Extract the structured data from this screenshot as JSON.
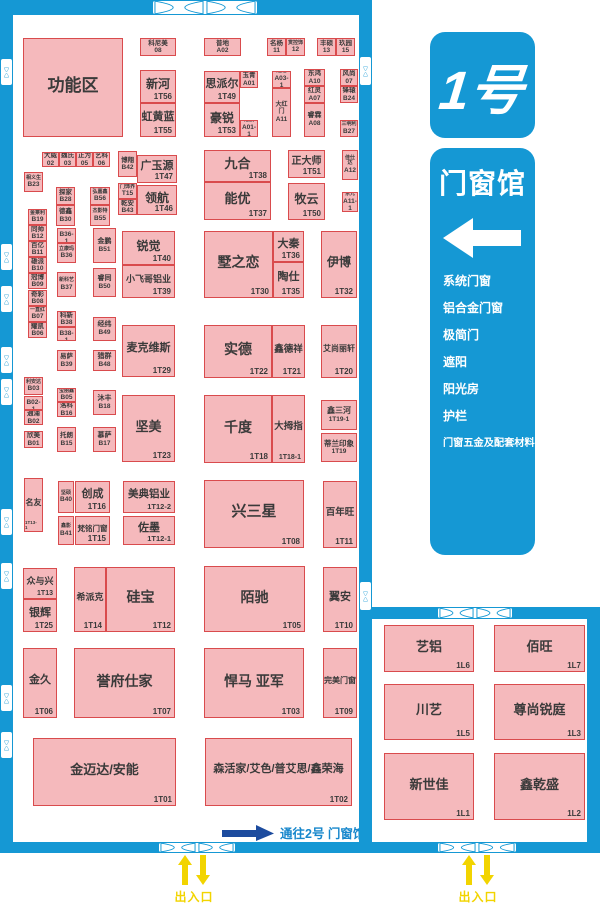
{
  "legend": {
    "hall_number": "1号",
    "hall_name": "门窗馆",
    "categories": [
      "系统门窗",
      "铝合金门窗",
      "极简门",
      "遮阳",
      "阳光房",
      "护栏",
      "门窗五金及配套材料"
    ]
  },
  "annotations": {
    "to_hall2": "通往2号 门窗馆",
    "entrance_exit": "出入口"
  },
  "colors": {
    "wall_blue": "#1598D4",
    "booth_fill": "#F5B9BC",
    "booth_border": "#D94B4D",
    "booth_text": "#3A3A3A",
    "navy_arrow": "#1C4B9E",
    "yellow": "#F2D400",
    "to_hall2_text": "#1787CC"
  },
  "booths": [
    {
      "n": "功能区",
      "c": "",
      "x": 23,
      "y": 38,
      "w": 100,
      "h": 99,
      "nf": 17
    },
    {
      "n": "科尼美",
      "c": "08",
      "x": 140,
      "y": 38,
      "w": 36,
      "h": 18,
      "t": "sm"
    },
    {
      "n": "新河",
      "c": "1T56",
      "x": 140,
      "y": 70,
      "w": 36,
      "h": 33,
      "nf": 12
    },
    {
      "n": "虹黄蓝",
      "c": "1T55",
      "x": 140,
      "y": 103,
      "w": 36,
      "h": 34,
      "nf": 11
    },
    {
      "n": "普地",
      "c": "A02",
      "x": 204,
      "y": 38,
      "w": 37,
      "h": 18,
      "t": "sm"
    },
    {
      "n": "名杨",
      "c": "11",
      "x": 267,
      "y": 38,
      "w": 19,
      "h": 18,
      "t": "sm"
    },
    {
      "n": "赏控饰",
      "c": "12",
      "x": 286,
      "y": 38,
      "w": 19,
      "h": 18,
      "t": "sm",
      "nf": 5
    },
    {
      "n": "丰硕",
      "c": "13",
      "x": 317,
      "y": 38,
      "w": 19,
      "h": 18,
      "t": "sm"
    },
    {
      "n": "玖园",
      "c": "15",
      "x": 336,
      "y": 38,
      "w": 19,
      "h": 18,
      "t": "sm"
    },
    {
      "n": "思派尔",
      "c": "1T49",
      "x": 204,
      "y": 71,
      "w": 36,
      "h": 32,
      "nf": 11
    },
    {
      "n": "玉青",
      "c": "A01",
      "x": 240,
      "y": 71,
      "w": 18,
      "h": 17,
      "t": "sm"
    },
    {
      "n": "豪锐",
      "c": "1T53",
      "x": 204,
      "y": 103,
      "w": 36,
      "h": 34,
      "nf": 12
    },
    {
      "n": "冠航",
      "c": "A01-1",
      "x": 240,
      "y": 120,
      "w": 18,
      "h": 17,
      "t": "sm",
      "nf": 5
    },
    {
      "n": "赵越",
      "c": "A03-1",
      "x": 272,
      "y": 71,
      "w": 19,
      "h": 17,
      "t": "sm",
      "nf": 5
    },
    {
      "n": "大红门",
      "c": "A11",
      "x": 272,
      "y": 88,
      "w": 19,
      "h": 49,
      "t": "sm",
      "nf": 6
    },
    {
      "n": "东鸿",
      "c": "A10",
      "x": 304,
      "y": 69,
      "w": 21,
      "h": 17,
      "t": "sm"
    },
    {
      "n": "红灵",
      "c": "A07",
      "x": 304,
      "y": 86,
      "w": 21,
      "h": 17,
      "t": "sm"
    },
    {
      "n": "睿霖",
      "c": "A08",
      "x": 304,
      "y": 103,
      "w": 21,
      "h": 34,
      "t": "sm",
      "nf": 7
    },
    {
      "n": "风尚",
      "c": "07",
      "x": 340,
      "y": 69,
      "w": 18,
      "h": 17,
      "t": "sm"
    },
    {
      "n": "锋辕",
      "c": "B24",
      "x": 340,
      "y": 86,
      "w": 18,
      "h": 17,
      "t": "sm"
    },
    {
      "n": "三明利",
      "c": "B27",
      "x": 340,
      "y": 120,
      "w": 18,
      "h": 17,
      "t": "sm",
      "nf": 5
    },
    {
      "n": "大威",
      "c": "02",
      "x": 42,
      "y": 152,
      "w": 17,
      "h": 15,
      "t": "sm"
    },
    {
      "n": "魏氏",
      "c": "03",
      "x": 59,
      "y": 152,
      "w": 17,
      "h": 15,
      "t": "sm"
    },
    {
      "n": "正为",
      "c": "05",
      "x": 76,
      "y": 152,
      "w": 17,
      "h": 15,
      "t": "sm"
    },
    {
      "n": "艺科",
      "c": "06",
      "x": 93,
      "y": 152,
      "w": 17,
      "h": 15,
      "t": "sm"
    },
    {
      "n": "博翔",
      "c": "B42",
      "x": 118,
      "y": 151,
      "w": 19,
      "h": 26,
      "t": "sm"
    },
    {
      "n": "广玉源",
      "c": "1T47",
      "x": 137,
      "y": 155,
      "w": 40,
      "h": 28,
      "nf": 11
    },
    {
      "n": "门饰界",
      "c": "T15",
      "x": 118,
      "y": 183,
      "w": 19,
      "h": 16,
      "t": "sm",
      "nf": 5
    },
    {
      "n": "乾安",
      "c": "B43",
      "x": 118,
      "y": 199,
      "w": 19,
      "h": 16,
      "t": "sm"
    },
    {
      "n": "领航",
      "c": "1T46",
      "x": 137,
      "y": 185,
      "w": 40,
      "h": 30,
      "nf": 12
    },
    {
      "n": "九合",
      "c": "1T38",
      "x": 204,
      "y": 150,
      "w": 67,
      "h": 32,
      "nf": 13
    },
    {
      "n": "能优",
      "c": "1T37",
      "x": 204,
      "y": 182,
      "w": 67,
      "h": 38,
      "nf": 13
    },
    {
      "n": "正大师",
      "c": "1T51",
      "x": 288,
      "y": 150,
      "w": 37,
      "h": 28,
      "nf": 10
    },
    {
      "n": "牧云",
      "c": "1T50",
      "x": 288,
      "y": 183,
      "w": 37,
      "h": 37,
      "nf": 12
    },
    {
      "n": "佳仕达",
      "c": "A12",
      "x": 342,
      "y": 150,
      "w": 16,
      "h": 30,
      "t": "sm",
      "nf": 5
    },
    {
      "n": "东元",
      "c": "A11-1",
      "x": 342,
      "y": 192,
      "w": 16,
      "h": 20,
      "t": "sm",
      "nf": 5
    },
    {
      "n": "相义生",
      "c": "B23",
      "x": 24,
      "y": 172,
      "w": 19,
      "h": 20,
      "t": "sm",
      "nf": 5
    },
    {
      "n": "金莱利",
      "c": "B19",
      "x": 28,
      "y": 209,
      "w": 19,
      "h": 16,
      "t": "sm",
      "nf": 5
    },
    {
      "n": "同帅",
      "c": "B12",
      "x": 28,
      "y": 225,
      "w": 19,
      "h": 16,
      "t": "sm"
    },
    {
      "n": "百亿",
      "c": "B11",
      "x": 28,
      "y": 241,
      "w": 19,
      "h": 16,
      "t": "sm"
    },
    {
      "n": "雄派",
      "c": "B10",
      "x": 28,
      "y": 257,
      "w": 19,
      "h": 16,
      "t": "sm"
    },
    {
      "n": "冠博",
      "c": "B09",
      "x": 28,
      "y": 273,
      "w": 19,
      "h": 16,
      "t": "sm"
    },
    {
      "n": "奇彩",
      "c": "B08",
      "x": 28,
      "y": 290,
      "w": 19,
      "h": 16,
      "t": "sm"
    },
    {
      "n": "一直红",
      "c": "B07",
      "x": 28,
      "y": 306,
      "w": 19,
      "h": 16,
      "t": "sm",
      "nf": 5
    },
    {
      "n": "耀凯",
      "c": "B06",
      "x": 28,
      "y": 322,
      "w": 19,
      "h": 16,
      "t": "sm"
    },
    {
      "n": "探家",
      "c": "B28",
      "x": 56,
      "y": 187,
      "w": 19,
      "h": 18,
      "t": "sm"
    },
    {
      "n": "德鑫",
      "c": "B30",
      "x": 56,
      "y": 205,
      "w": 19,
      "h": 21,
      "t": "sm"
    },
    {
      "n": "弘嘉鑫",
      "c": "B56",
      "x": 90,
      "y": 187,
      "w": 20,
      "h": 18,
      "t": "sm",
      "nf": 5
    },
    {
      "n": "杰影特",
      "c": "B55",
      "x": 90,
      "y": 205,
      "w": 20,
      "h": 21,
      "t": "sm",
      "nf": 5
    },
    {
      "n": "利安达",
      "c": "B03",
      "x": 24,
      "y": 377,
      "w": 19,
      "h": 18,
      "t": "sm",
      "nf": 5
    },
    {
      "n": "角园",
      "c": "B02-1",
      "x": 24,
      "y": 396,
      "w": 19,
      "h": 14,
      "t": "sm",
      "nf": 5
    },
    {
      "n": "通浦",
      "c": "B02",
      "x": 24,
      "y": 410,
      "w": 19,
      "h": 15,
      "t": "sm"
    },
    {
      "n": "欣美",
      "c": "B01",
      "x": 24,
      "y": 431,
      "w": 19,
      "h": 17,
      "t": "sm"
    },
    {
      "n": "名友",
      "c": "1T13-1",
      "x": 24,
      "y": 478,
      "w": 19,
      "h": 54,
      "nf": 8,
      "cf": 4.5
    },
    {
      "n": "彬利",
      "c": "B36-1",
      "x": 57,
      "y": 228,
      "w": 19,
      "h": 15,
      "t": "sm",
      "nf": 5
    },
    {
      "n": "立康玛",
      "c": "B36",
      "x": 57,
      "y": 243,
      "w": 19,
      "h": 20,
      "t": "sm",
      "nf": 5
    },
    {
      "n": "新科艺",
      "c": "B37",
      "x": 57,
      "y": 272,
      "w": 19,
      "h": 25,
      "t": "sm",
      "nf": 5
    },
    {
      "n": "金鹏",
      "c": "B51",
      "x": 93,
      "y": 228,
      "w": 23,
      "h": 35,
      "t": "sm",
      "nf": 7
    },
    {
      "n": "睿同",
      "c": "B50",
      "x": 93,
      "y": 268,
      "w": 23,
      "h": 29,
      "t": "sm",
      "nf": 7
    },
    {
      "n": "科新",
      "c": "B38",
      "x": 57,
      "y": 311,
      "w": 19,
      "h": 16,
      "t": "sm"
    },
    {
      "n": "宾普",
      "c": "B38-1",
      "x": 57,
      "y": 327,
      "w": 19,
      "h": 14,
      "t": "sm",
      "nf": 5
    },
    {
      "n": "易萨",
      "c": "B39",
      "x": 57,
      "y": 350,
      "w": 19,
      "h": 21,
      "t": "sm"
    },
    {
      "n": "经纬",
      "c": "B49",
      "x": 93,
      "y": 317,
      "w": 23,
      "h": 24,
      "t": "sm",
      "nf": 7
    },
    {
      "n": "猎群",
      "c": "B48",
      "x": 93,
      "y": 350,
      "w": 23,
      "h": 21,
      "t": "sm",
      "nf": 7
    },
    {
      "n": "宝丽鑫",
      "c": "B05",
      "x": 57,
      "y": 388,
      "w": 19,
      "h": 14,
      "t": "sm",
      "nf": 5
    },
    {
      "n": "洛科",
      "c": "B16",
      "x": 57,
      "y": 402,
      "w": 19,
      "h": 15,
      "t": "sm"
    },
    {
      "n": "托朗",
      "c": "B15",
      "x": 57,
      "y": 427,
      "w": 19,
      "h": 25,
      "t": "sm"
    },
    {
      "n": "沐丰",
      "c": "B18",
      "x": 93,
      "y": 390,
      "w": 23,
      "h": 25,
      "t": "sm",
      "nf": 7
    },
    {
      "n": "慕萨",
      "c": "B17",
      "x": 93,
      "y": 427,
      "w": 23,
      "h": 25,
      "t": "sm",
      "nf": 7
    },
    {
      "n": "坚硕",
      "c": "B40",
      "x": 58,
      "y": 481,
      "w": 16,
      "h": 32,
      "t": "sm",
      "nf": 5
    },
    {
      "n": "鑫影",
      "c": "B41",
      "x": 58,
      "y": 516,
      "w": 16,
      "h": 29,
      "t": "sm",
      "nf": 5
    },
    {
      "n": "锐觉",
      "c": "1T40",
      "x": 122,
      "y": 231,
      "w": 53,
      "h": 34,
      "nf": 12
    },
    {
      "n": "小飞哥铝业",
      "c": "1T39",
      "x": 122,
      "y": 265,
      "w": 53,
      "h": 33,
      "nf": 9
    },
    {
      "n": "墅之恋",
      "c": "1T30",
      "x": 204,
      "y": 231,
      "w": 69,
      "h": 67,
      "nf": 14
    },
    {
      "n": "大秦",
      "c": "1T36",
      "x": 273,
      "y": 231,
      "w": 31,
      "h": 31,
      "nf": 11
    },
    {
      "n": "陶仕",
      "c": "1T35",
      "x": 273,
      "y": 262,
      "w": 31,
      "h": 36,
      "nf": 11
    },
    {
      "n": "伊博",
      "c": "1T32",
      "x": 321,
      "y": 231,
      "w": 36,
      "h": 67,
      "nf": 12
    },
    {
      "n": "麦克维斯",
      "c": "1T29",
      "x": 122,
      "y": 325,
      "w": 53,
      "h": 52,
      "nf": 11
    },
    {
      "n": "实德",
      "c": "1T22",
      "x": 204,
      "y": 325,
      "w": 68,
      "h": 53,
      "nf": 14
    },
    {
      "n": "鑫德祥",
      "c": "1T21",
      "x": 272,
      "y": 325,
      "w": 33,
      "h": 53,
      "nf": 9.5
    },
    {
      "n": "艾尚丽轩",
      "c": "1T20",
      "x": 321,
      "y": 325,
      "w": 36,
      "h": 53,
      "nf": 8
    },
    {
      "n": "坚美",
      "c": "1T23",
      "x": 122,
      "y": 395,
      "w": 53,
      "h": 67,
      "nf": 13
    },
    {
      "n": "千度",
      "c": "1T18",
      "x": 204,
      "y": 395,
      "w": 68,
      "h": 68,
      "nf": 14
    },
    {
      "n": "大拇指",
      "c": "1T18-1",
      "x": 272,
      "y": 395,
      "w": 33,
      "h": 68,
      "nf": 9.5,
      "cf": 7
    },
    {
      "n": "鑫三河",
      "c": "1T19-1",
      "x": 321,
      "y": 400,
      "w": 36,
      "h": 30,
      "t": "sm",
      "nf": 8
    },
    {
      "n": "蒂兰印象",
      "c": "1T19",
      "x": 321,
      "y": 433,
      "w": 36,
      "h": 29,
      "t": "sm",
      "nf": 7.5
    },
    {
      "n": "创成",
      "c": "1T16",
      "x": 75,
      "y": 481,
      "w": 35,
      "h": 32,
      "nf": 11
    },
    {
      "n": "梵铭门窗",
      "c": "1T15",
      "x": 75,
      "y": 516,
      "w": 35,
      "h": 29,
      "nf": 7.5
    },
    {
      "n": "美典铝业",
      "c": "1T12-2",
      "x": 123,
      "y": 481,
      "w": 52,
      "h": 32,
      "nf": 10.5,
      "cf": 7.5
    },
    {
      "n": "佐墨",
      "c": "1T12-1",
      "x": 123,
      "y": 516,
      "w": 52,
      "h": 29,
      "nf": 11,
      "cf": 7.5
    },
    {
      "n": "兴三星",
      "c": "1T08",
      "x": 204,
      "y": 480,
      "w": 100,
      "h": 68,
      "nf": 15
    },
    {
      "n": "百年旺",
      "c": "1T11",
      "x": 323,
      "y": 481,
      "w": 34,
      "h": 67,
      "nf": 9.5
    },
    {
      "n": "众与兴",
      "c": "1T13",
      "x": 23,
      "y": 568,
      "w": 34,
      "h": 31,
      "nf": 9,
      "cf": 7
    },
    {
      "n": "银辉",
      "c": "1T25",
      "x": 23,
      "y": 599,
      "w": 34,
      "h": 33,
      "nf": 11
    },
    {
      "n": "希派克",
      "c": "1T14",
      "x": 74,
      "y": 567,
      "w": 32,
      "h": 65,
      "nf": 9
    },
    {
      "n": "硅宝",
      "c": "1T12",
      "x": 106,
      "y": 567,
      "w": 69,
      "h": 65,
      "nf": 14
    },
    {
      "n": "陌驰",
      "c": "1T05",
      "x": 204,
      "y": 566,
      "w": 101,
      "h": 66,
      "nf": 14
    },
    {
      "n": "翼安",
      "c": "1T10",
      "x": 323,
      "y": 567,
      "w": 34,
      "h": 65,
      "nf": 11
    },
    {
      "n": "金久",
      "c": "1T06",
      "x": 23,
      "y": 648,
      "w": 34,
      "h": 70,
      "nf": 11
    },
    {
      "n": "誉府仕家",
      "c": "1T07",
      "x": 74,
      "y": 648,
      "w": 101,
      "h": 70,
      "nf": 14
    },
    {
      "n": "悍马 亚军",
      "c": "1T03",
      "x": 204,
      "y": 648,
      "w": 100,
      "h": 70,
      "nf": 14
    },
    {
      "n": "完美门窗",
      "c": "1T09",
      "x": 323,
      "y": 648,
      "w": 34,
      "h": 70,
      "nf": 8
    },
    {
      "n": "金迈达/安能",
      "c": "1T01",
      "x": 33,
      "y": 738,
      "w": 143,
      "h": 68,
      "nf": 13
    },
    {
      "n": "森活家/艾色/普艾思/鑫荣海",
      "c": "1T02",
      "x": 205,
      "y": 738,
      "w": 147,
      "h": 68,
      "nf": 11
    },
    {
      "n": "艺铝",
      "c": "1L6",
      "x": 384,
      "y": 625,
      "w": 90,
      "h": 47,
      "nf": 13
    },
    {
      "n": "佰旺",
      "c": "1L7",
      "x": 494,
      "y": 625,
      "w": 91,
      "h": 47,
      "nf": 13
    },
    {
      "n": "川艺",
      "c": "1L5",
      "x": 384,
      "y": 684,
      "w": 90,
      "h": 56,
      "nf": 13
    },
    {
      "n": "尊尚锐庭",
      "c": "1L3",
      "x": 494,
      "y": 684,
      "w": 91,
      "h": 56,
      "nf": 13
    },
    {
      "n": "新世佳",
      "c": "1L1",
      "x": 384,
      "y": 753,
      "w": 90,
      "h": 67,
      "nf": 13
    },
    {
      "n": "鑫乾盛",
      "c": "1L2",
      "x": 494,
      "y": 753,
      "w": 91,
      "h": 67,
      "nf": 13
    }
  ]
}
